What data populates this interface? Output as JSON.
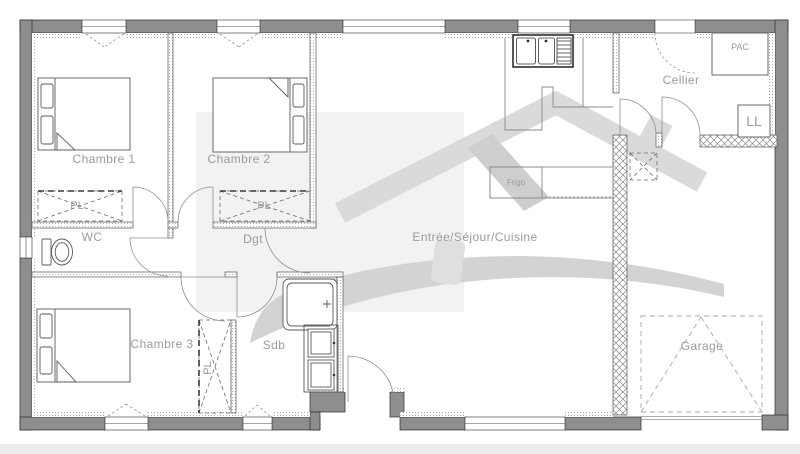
{
  "theme": {
    "background": "#ffffff",
    "wall_fill": "#8e8e8e",
    "label_color": "#9b9b9b",
    "watermark_color": "#d7d7d7",
    "footer_strip": "#ececec"
  },
  "plan": {
    "rooms": {
      "chambre1": {
        "label": "Chambre 1"
      },
      "chambre2": {
        "label": "Chambre 2"
      },
      "chambre3": {
        "label": "Chambre 3"
      },
      "wc": {
        "label": "WC"
      },
      "dgt": {
        "label": "Dgt"
      },
      "sdb": {
        "label": "Sdb"
      },
      "sejour": {
        "label": "Entrée/Séjour/Cuisine"
      },
      "cellier": {
        "label": "Cellier"
      },
      "garage": {
        "label": "Garage"
      }
    },
    "fixtures": {
      "closet1": {
        "label": "PL"
      },
      "closet2": {
        "label": "PL"
      },
      "closet3": {
        "label": "PL"
      },
      "fridge": {
        "label": "Frigo"
      },
      "heat_pump": {
        "label": "PAC"
      },
      "washer": {
        "label": "LL"
      }
    }
  }
}
